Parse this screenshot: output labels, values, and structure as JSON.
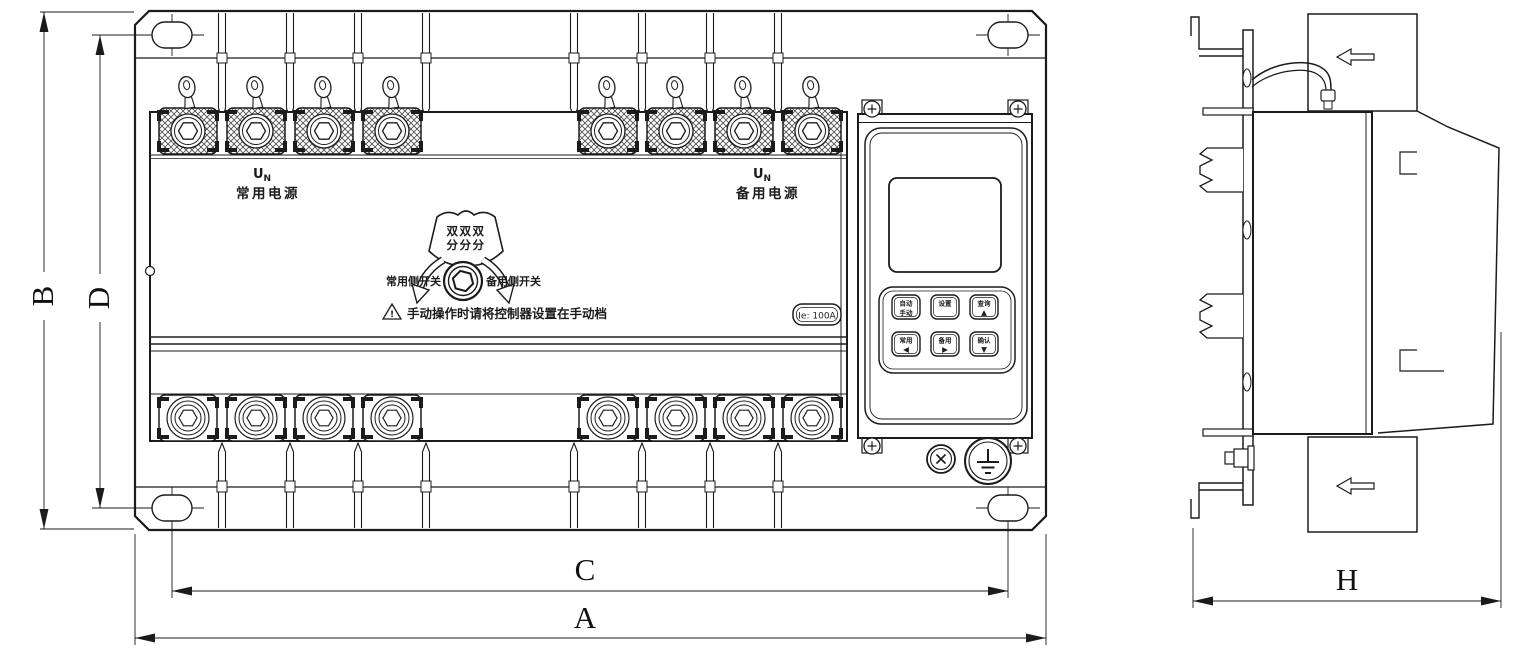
{
  "colors": {
    "ink": "#1b1b1b",
    "paper": "#ffffff"
  },
  "front_view": {
    "normal_power": {
      "symbol_main": "U",
      "symbol_sub": "N",
      "label": "常用电源"
    },
    "backup_power": {
      "symbol_main": "U",
      "symbol_sub": "N",
      "label": "备用电源"
    },
    "handle": {
      "plate_row1": "双双双",
      "plate_row2": "分分分",
      "left_label": "常用侧开关",
      "right_label": "备用侧开关"
    },
    "warning": {
      "mark": "!",
      "text": "手动操作时请将控制器设置在手动档"
    },
    "rating_badge": "Ie: 100A",
    "controller": {
      "buttons": [
        {
          "line1": "自动",
          "line2": "手动"
        },
        {
          "line1": "设置",
          "line2": ""
        },
        {
          "line1": "查询",
          "line2": "▲"
        },
        {
          "line1": "常用",
          "line2": "◀"
        },
        {
          "line1": "备用",
          "line2": "▶"
        },
        {
          "line1": "确认",
          "line2": "▼"
        }
      ]
    }
  },
  "dimensions": {
    "overall_width": "A",
    "mounting_width": "C",
    "overall_height": "B",
    "mounting_height": "D",
    "depth": "H"
  }
}
